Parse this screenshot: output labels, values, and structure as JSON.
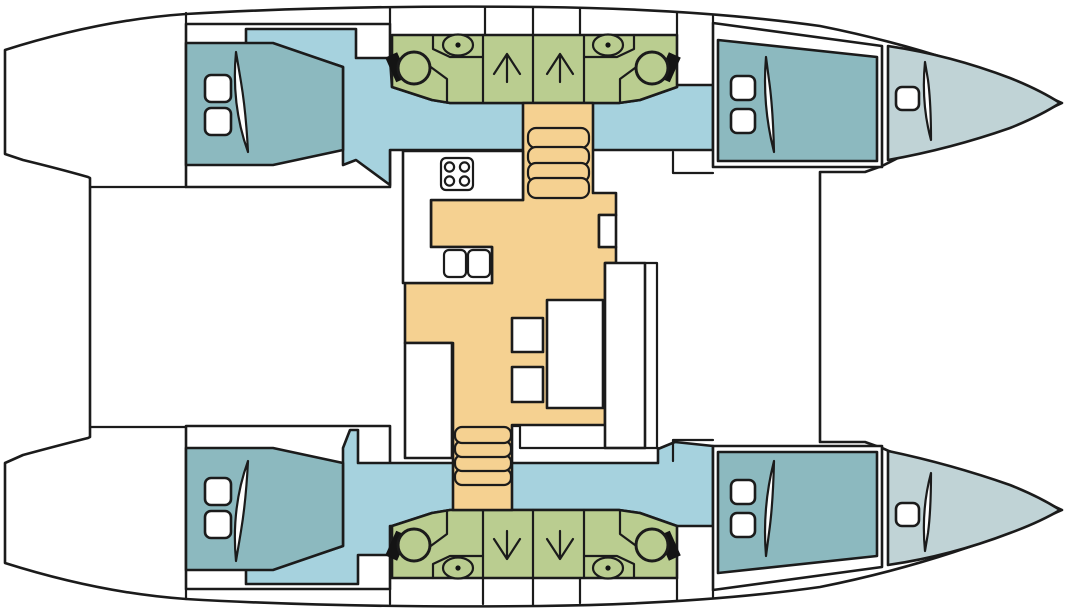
{
  "colors": {
    "outline": "#1b1b1b",
    "white": "#ffffff",
    "passage_blue": "#a6d2de",
    "cabin_teal": "#8cb9bf",
    "bathroom_green": "#bacd90",
    "salon_orange": "#f5d191",
    "forepeak_gray": "#c0d3d6",
    "fixture_black": "#141414"
  }
}
